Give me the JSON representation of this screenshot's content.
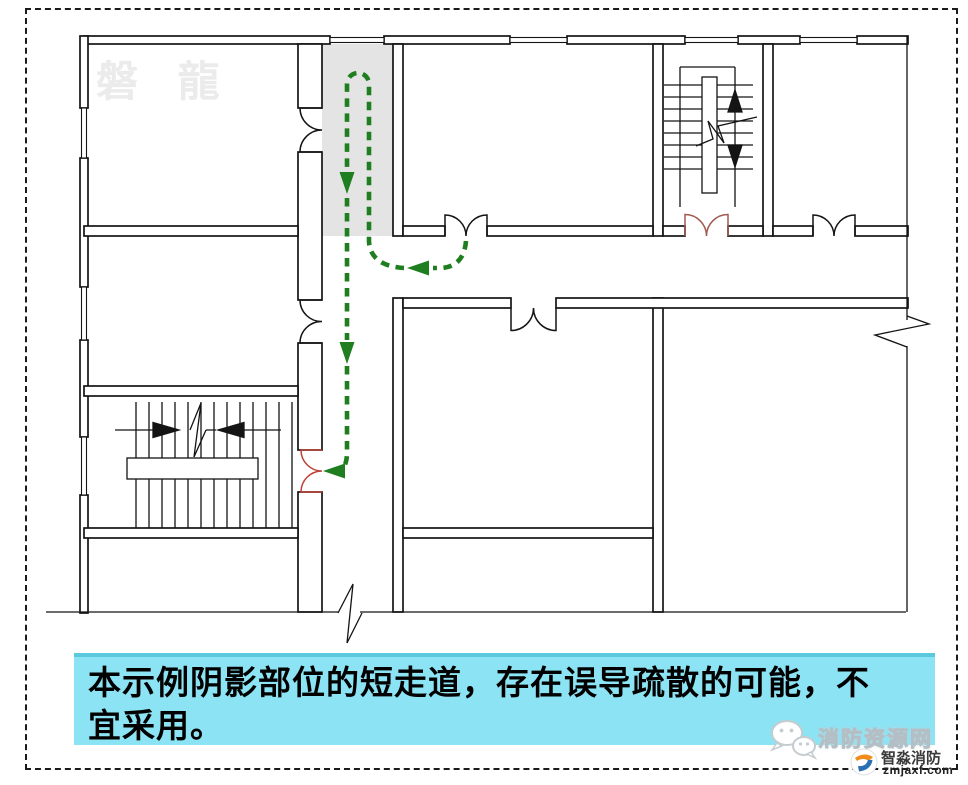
{
  "page": {
    "background": "#ffffff",
    "border_color": "#1b1b1b"
  },
  "watermark": {
    "text": "磐 龍",
    "color": "#ebebeb"
  },
  "caption": {
    "full_text": "本示例阴影部位的短走道，存在误导疏散的可能，不宜采用。",
    "line1": "本示例阴影部位的短走道，存在误导疏散的可能，不",
    "line2": "宜采用。",
    "bg_color": "#8ce3f4",
    "edge_color": "#5ac9de",
    "text_color": "#000000"
  },
  "diagram": {
    "type": "fire-evacuation-floor-plan",
    "colors": {
      "wall": "#141414",
      "shade_gray": "#e4e4e4",
      "route_green": "#1f7e1f",
      "exit_door_red": "#bf4136",
      "stair_door_red": "#a25a50"
    },
    "features": {
      "shaded_short_corridor": true,
      "dashed_evacuation_route": true,
      "stairs_count": 2,
      "door_count": 7,
      "break_symbol_count": 4
    }
  },
  "branding": {
    "wechat_icon": "wechat-icon",
    "site_name": "消防资源网",
    "company_logo": "zhimiao-logo-icon",
    "company_name": "智淼消防",
    "domain": "zmjaxf.com"
  }
}
